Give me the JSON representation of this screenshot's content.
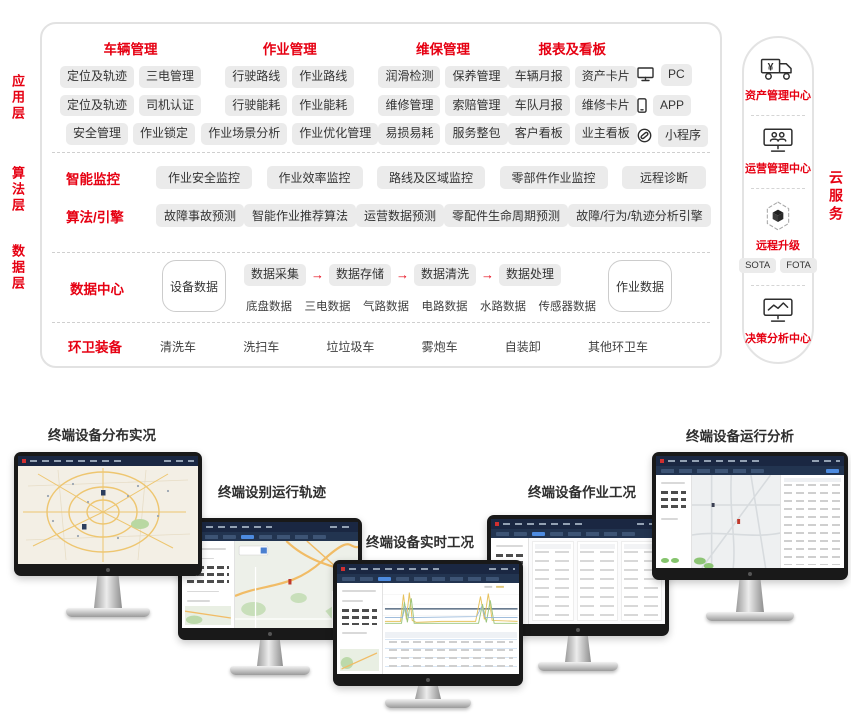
{
  "colors": {
    "accent_red": "#e60012",
    "pill_bg": "#ebebeb",
    "topbar_navy": "#1a2742",
    "active_blue": "#4d8be0"
  },
  "icons": {
    "flow_arrow": "→",
    "yen": "¥"
  },
  "architecture": {
    "layer_labels": [
      "应用层",
      "算法层",
      "数据层"
    ],
    "application": {
      "groups": [
        {
          "title": "车辆管理",
          "rows": [
            [
              "定位及轨迹",
              "三电管理"
            ],
            [
              "定位及轨迹",
              "司机认证"
            ],
            [
              "安全管理",
              "作业锁定"
            ]
          ]
        },
        {
          "title": "作业管理",
          "rows": [
            [
              "行驶路线",
              "作业路线"
            ],
            [
              "行驶能耗",
              "作业能耗"
            ],
            [
              "作业场景分析",
              "作业优化管理"
            ]
          ]
        },
        {
          "title": "维保管理",
          "rows": [
            [
              "润滑检测",
              "保养管理"
            ],
            [
              "维修管理",
              "索赔管理"
            ],
            [
              "易损易耗",
              "服务整包"
            ]
          ]
        },
        {
          "title": "报表及看板",
          "rows": [
            [
              "车辆月报",
              "资产卡片"
            ],
            [
              "车队月报",
              "维修卡片"
            ],
            [
              "客户看板",
              "业主看板"
            ]
          ]
        }
      ],
      "channels": [
        {
          "icon": "pc-icon",
          "label": "PC"
        },
        {
          "icon": "phone-icon",
          "label": "APP"
        },
        {
          "icon": "link-icon",
          "label": "小程序"
        }
      ]
    },
    "algorithm": {
      "rows": [
        {
          "label": "智能监控",
          "items": [
            "作业安全监控",
            "作业效率监控",
            "路线及区域监控",
            "零部件作业监控",
            "远程诊断"
          ]
        },
        {
          "label": "算法/引擎",
          "items": [
            "故障事故预测",
            "智能作业推荐算法",
            "运营数据预测",
            "零配件生命周期预测",
            "故障/行为/轨迹分析引擎"
          ]
        }
      ]
    },
    "data_center": {
      "label": "数据中心",
      "device_store": "设备数据",
      "flow": [
        "数据采集",
        "数据存储",
        "数据清洗",
        "数据处理"
      ],
      "sources": [
        "底盘数据",
        "三电数据",
        "气路数据",
        "电路数据",
        "水路数据",
        "传感器数据"
      ],
      "work_store": "作业数据"
    },
    "equipment": {
      "label": "环卫装备",
      "items": [
        "清洗车",
        "洗扫车",
        "垃垃圾车",
        "雾炮车",
        "自装卸",
        "其他环卫车"
      ]
    }
  },
  "cloud_panel": {
    "vertical_label": "云服务",
    "sections": [
      {
        "icon": "truck-yen-icon",
        "label": "资产管理中心"
      },
      {
        "icon": "monitor-users-icon",
        "label": "运营管理中心"
      },
      {
        "icon": "cube-hex-icon",
        "label": "远程升级",
        "pills": [
          "SOTA",
          "FOTA"
        ]
      },
      {
        "icon": "monitor-chart-icon",
        "label": "决策分析中心"
      }
    ]
  },
  "monitors": [
    {
      "label": "终端设备分布实况",
      "screen": "map-overview"
    },
    {
      "label": "终端设别运行轨迹",
      "screen": "map-trajectory"
    },
    {
      "label": "终端设备实时工况",
      "screen": "realtime-charts"
    },
    {
      "label": "终端设备作业工况",
      "screen": "operation-table"
    },
    {
      "label": "终端设备运行分析",
      "screen": "analysis-map"
    }
  ]
}
